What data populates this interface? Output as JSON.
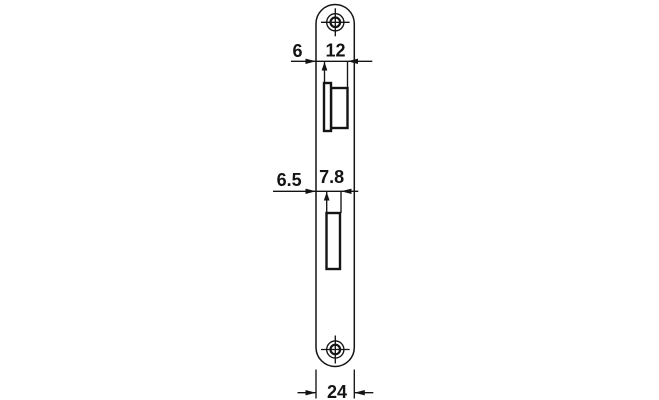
{
  "labels": {
    "offset_top": "6",
    "latch_cutout_width": "12",
    "offset_mid": "6.5",
    "bolt_cutout_width": "7.8",
    "plate_width": "24"
  },
  "colors": {
    "line": "#141414",
    "background": "#ffffff"
  }
}
